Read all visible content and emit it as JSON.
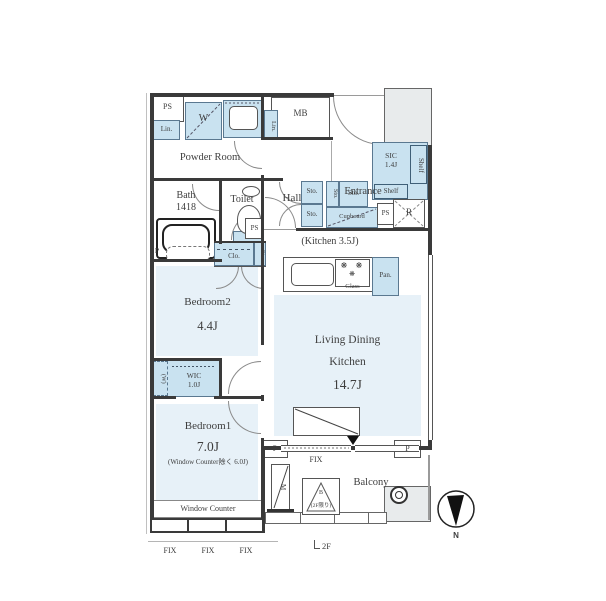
{
  "colors": {
    "room_fill": "#e7f1f8",
    "closet_fill": "#c9e2f0",
    "void_fill": "#e8ebec",
    "wall": "#3a3a3a",
    "text": "#3e3e3e",
    "line": "#777777"
  },
  "rooms": {
    "powder_room": "Powder Room",
    "bath": "Bath",
    "bath_size": "1418",
    "toilet": "Toilet",
    "hall": "Hall",
    "entrance": "Entrance",
    "sic": "SIC",
    "sic_size": "1.4J",
    "kitchen_note": "(Kitchen 3.5J)",
    "ldk_line1": "Living Dining",
    "ldk_line2": "Kitchen",
    "ldk_size": "14.7J",
    "bedroom2": "Bedroom2",
    "bedroom2_size": "4.4J",
    "bedroom1": "Bedroom1",
    "bedroom1_size": "7.0J",
    "bedroom1_note": "(Window Counter除く 6.0J)",
    "wic": "WIC",
    "wic_size": "1.0J",
    "balcony": "Balcony"
  },
  "fixtures": {
    "ps": "PS",
    "mb": "MB",
    "washer": "W",
    "linen": "Lin.",
    "storage": "Sto.",
    "closet": "Clo.",
    "cupboard": "Cupboard",
    "shelf": "Shelf",
    "refrigerator": "R",
    "pantry": "Pan.",
    "glass_top": "Glass",
    "pipe": "P",
    "washer_space": "(W)",
    "window_counter": "Window Counter",
    "fix_window": "FIX",
    "partition": "M",
    "hatch": "B",
    "hatch_note": "(2F限り)",
    "floor_marker": "2F",
    "north": "N"
  }
}
